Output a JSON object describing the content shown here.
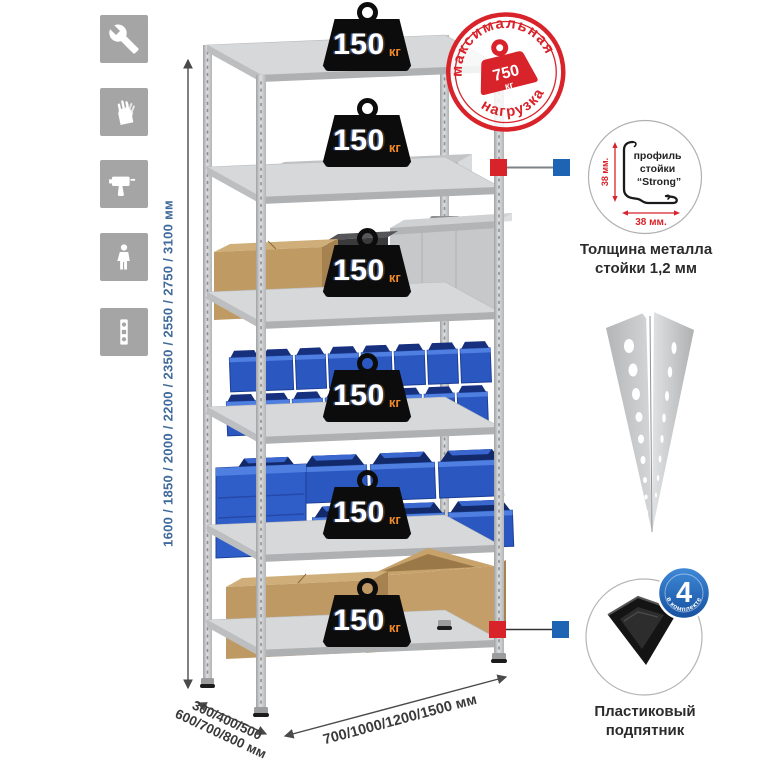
{
  "page": {
    "background": "#ffffff"
  },
  "assembly_icons": [
    {
      "name": "wrench"
    },
    {
      "name": "gloves"
    },
    {
      "name": "drill"
    },
    {
      "name": "person"
    },
    {
      "name": "spirit-level"
    }
  ],
  "dimensions": {
    "height_label": "1600 / 1850 / 2000 / 2200 / 2350 / 2550 / 2750 / 3100 мм",
    "depth_label_line1": "300/400/500",
    "depth_label_line2": "600/700/800 мм",
    "width_label": "700/1000/1200/1500 мм"
  },
  "rack": {
    "shelf_count": 6,
    "shelf_load": {
      "value": "150",
      "unit": "кг"
    }
  },
  "max_load_stamp": {
    "top_text": "максимальная",
    "bottom_text": "нагрузка",
    "value": "750",
    "unit": "кг"
  },
  "profile_detail": {
    "line1": "профиль",
    "line2": "стойки",
    "line3": "“Strong”",
    "dim_vertical": "38 мм.",
    "dim_horizontal": "38 мм.",
    "caption_line1": "Толщина металла",
    "caption_line2": "стойки 1,2 мм"
  },
  "foot_detail": {
    "badge_count": "4",
    "badge_text": "в комплекте",
    "caption_line1": "Пластиковый",
    "caption_line2": "подпятник"
  },
  "colors": {
    "stamp_red": "#d8232a",
    "marker_red": "#d8232a",
    "marker_blue": "#1d64b5",
    "badge_blue": "#1d64b5",
    "bin_blue": "#2b57c0",
    "dimension_text_blue": "#3f6a9a",
    "icon_gray": "#a5a5a5",
    "metal_gray": "#c7c9cb",
    "cardboard": "#bf9963"
  }
}
